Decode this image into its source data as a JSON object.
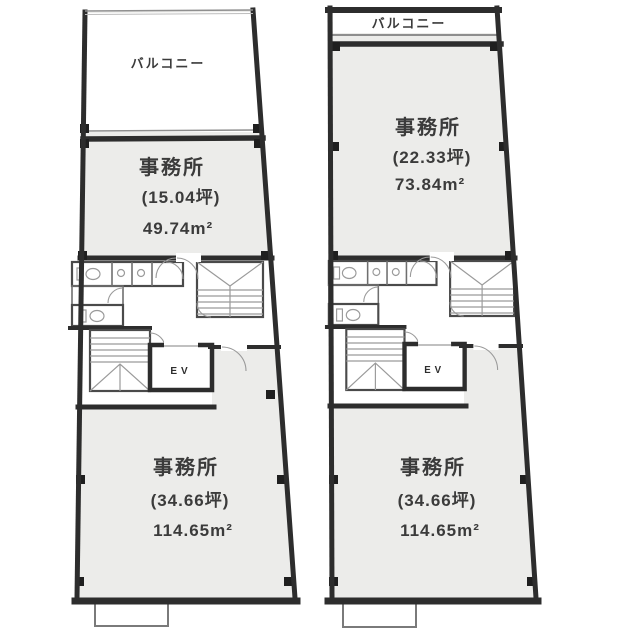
{
  "colors": {
    "background": "#ffffff",
    "wall": "#2d2d2d",
    "room_fill": "#ececea",
    "thin_line": "#8f8f8f",
    "text": "#3b3b3b"
  },
  "fixtures": {
    "elevator_label": "EV"
  },
  "plans": {
    "left": {
      "balcony_label": "バルコニー",
      "office_top": {
        "name": "事務所",
        "tsubo": "(15.04坪)",
        "area": "49.74m²"
      },
      "office_bottom": {
        "name": "事務所",
        "tsubo": "(34.66坪)",
        "area": "114.65m²"
      }
    },
    "right": {
      "balcony_label": "バルコニー",
      "office_top": {
        "name": "事務所",
        "tsubo": "(22.33坪)",
        "area": "73.84m²"
      },
      "office_bottom": {
        "name": "事務所",
        "tsubo": "(34.66坪)",
        "area": "114.65m²"
      }
    }
  }
}
